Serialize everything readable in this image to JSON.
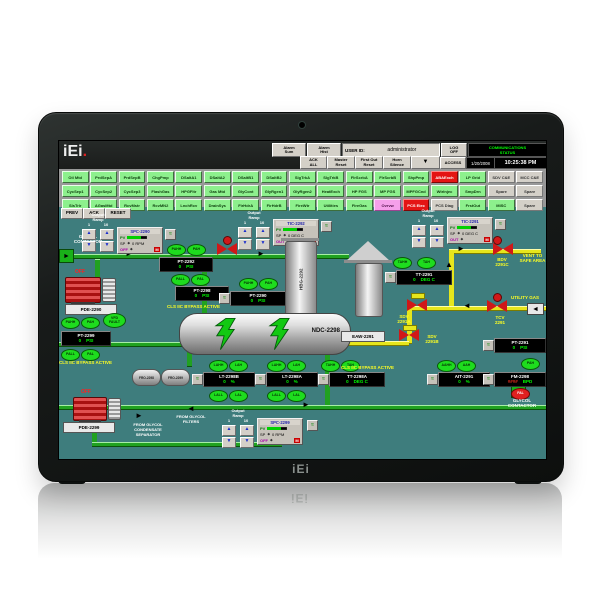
{
  "device": {
    "front_logo": "iEi",
    "reflection_logo": "iEi",
    "screen_logo_text": "iEi",
    "screen_logo_dot": "."
  },
  "icons": {
    "up": "▲",
    "down": "▼",
    "left": "◄",
    "right": "►",
    "trend": "≈",
    "diamond": "◆"
  },
  "header": {
    "alarm_sum": "Alarm\nSum",
    "alarm_hist": "Alarm\nHist",
    "user_id_label": "USER ID:",
    "user_id_value": "administrator",
    "log_off": "LOG\nOFF",
    "comm_status": "COMMUNICATIONS\nSTATUS",
    "ack_all": "ACK\nALL",
    "master_reset": "Master\nReset",
    "first_out_reset": "First Out\nReset",
    "horn_silence": "Horn\nSilence",
    "access": "ACCESS",
    "date": "1/20/2008",
    "time": "10:25:38 PM"
  },
  "nav_grid": {
    "rows": [
      [
        {
          "label": "Oil Mtd",
          "color": "green"
        },
        {
          "label": "PrdSepA",
          "color": "green"
        },
        {
          "label": "PrdSepB",
          "color": "green"
        },
        {
          "label": "ChgPmp",
          "color": "green"
        },
        {
          "label": "DSaltA1",
          "color": "green"
        },
        {
          "label": "DSaltA2",
          "color": "green"
        },
        {
          "label": "DSaltB1",
          "color": "green"
        },
        {
          "label": "DSaltB2",
          "color": "green"
        },
        {
          "label": "SlgTrkA",
          "color": "green"
        },
        {
          "label": "SlgTrkB",
          "color": "green"
        },
        {
          "label": "FlrScrbA",
          "color": "green"
        },
        {
          "label": "FlrScrbB",
          "color": "green"
        },
        {
          "label": "ShpPmp",
          "color": "green"
        },
        {
          "label": "ABAExch",
          "color": "red"
        },
        {
          "label": "LP Grid",
          "color": "green"
        },
        {
          "label": "SDV C&E",
          "color": "gray"
        },
        {
          "label": "MCC C&E",
          "color": "gray"
        }
      ],
      [
        {
          "label": "CycSep1",
          "color": "green"
        },
        {
          "label": "CycSep2",
          "color": "green"
        },
        {
          "label": "CycSep3",
          "color": "green"
        },
        {
          "label": "FlashGas",
          "color": "green"
        },
        {
          "label": "HPGFltr",
          "color": "green"
        },
        {
          "label": "Gas Mtd",
          "color": "green"
        },
        {
          "label": "GlyCont",
          "color": "green"
        },
        {
          "label": "GlyRgen1",
          "color": "green"
        },
        {
          "label": "GlyRgen2",
          "color": "green"
        },
        {
          "label": "HeatExch",
          "color": "green"
        },
        {
          "label": "HP FGS",
          "color": "green"
        },
        {
          "label": "MP FGS",
          "color": "green"
        },
        {
          "label": "MPFGCnd",
          "color": "green"
        },
        {
          "label": "WtrInjec",
          "color": "green"
        },
        {
          "label": "SmpDrn",
          "color": "green"
        },
        {
          "label": "Spare",
          "color": "gray"
        },
        {
          "label": "Spare",
          "color": "gray"
        }
      ],
      [
        {
          "label": "SlsTrlr",
          "color": "green"
        },
        {
          "label": "AGasMtd",
          "color": "green"
        },
        {
          "label": "RcvMstr",
          "color": "green"
        },
        {
          "label": "RcvMN2",
          "color": "green"
        },
        {
          "label": "LnchRcv",
          "color": "green"
        },
        {
          "label": "DrainSys",
          "color": "green"
        },
        {
          "label": "FirHdrA",
          "color": "green"
        },
        {
          "label": "FirHdrB",
          "color": "green"
        },
        {
          "label": "FireWtr",
          "color": "green"
        },
        {
          "label": "Utilities",
          "color": "green"
        },
        {
          "label": "FireGas",
          "color": "green"
        },
        {
          "label": "Ovrvw",
          "color": "pink"
        },
        {
          "label": "PCS Elec",
          "color": "red"
        },
        {
          "label": "PCS Diag",
          "color": "gray"
        },
        {
          "label": "FrstOut",
          "color": "green"
        },
        {
          "label": "MISC",
          "color": "green"
        },
        {
          "label": "Spare",
          "color": "gray"
        }
      ]
    ]
  },
  "alarm_bar": {
    "prev": "PREV",
    "ack": "ACK",
    "reset": "RESET"
  },
  "hmi": {
    "texts": {
      "glycol_contactor_left": "GLYCOL\nCONTACTOR",
      "glycol_contactor_right": "GLYCOL\nCONTACTOR",
      "bypass_active": "CLS IIC BYPASS ACTIVE",
      "vent_safe_area": "VENT TO\nSAFE AREA",
      "utility_gas": "UTILITY GAS",
      "bdv_2291c": "BDV\n2291C",
      "tcv_2291": "TCV\n2291",
      "sdv_2291a": "SDV\n2291A",
      "sdv_2291b": "SDV\n2291B",
      "from_condensate": "FROM GLYCOL\nCONDENSATE\nSEPARATOR",
      "from_filters": "FROM GLYCOL\nFILTERS",
      "pump1_status": "OFF",
      "pump2_status": "OFF"
    },
    "equipment": {
      "vessel": "NDC-2298",
      "exchanger_tag": "EAW-2291",
      "column": "HBG-2292",
      "pump1": "PDE-2290",
      "pump2": "PDE-2299",
      "drum1": "FRO-2298",
      "drum2": "FRO-2299"
    },
    "output_ramp": {
      "label": "Output\nRamp",
      "range_low": "1",
      "range_high": "10"
    },
    "faceplates": [
      {
        "title": "SPC-2290",
        "pv": "PV",
        "sp_label": "SP",
        "sp_value": "0 RPM",
        "out_label": "OFF",
        "mode": "M"
      },
      {
        "title": "TIC-2292",
        "pv": "PV",
        "sp_label": "SP",
        "sp_value": "0 DEG C",
        "out_label": "OUT",
        "mode": "M"
      },
      {
        "title": "TIC-2291",
        "pv": "PV",
        "sp_label": "SP",
        "sp_value": "0 DEG C",
        "out_label": "OUT",
        "mode": "M"
      },
      {
        "title": "SPC-2299",
        "pv": "PV",
        "sp_label": "SP",
        "sp_value": "0 RPM",
        "out_label": "OFF",
        "mode": "M"
      }
    ],
    "readouts": [
      {
        "title": "PT-2292",
        "value": "0",
        "unit": "PSI"
      },
      {
        "title": "PT-2298",
        "value": "0",
        "unit": "PSI"
      },
      {
        "title": "PT-2299",
        "value": "0",
        "unit": "PSI"
      },
      {
        "title": "PT-2290",
        "value": "0",
        "unit": "PSI"
      },
      {
        "title": "TT-2291",
        "value": "0",
        "unit": "DEG C"
      },
      {
        "title": "LT-2298B",
        "value": "0",
        "unit": "%"
      },
      {
        "title": "LT-2298A",
        "value": "0",
        "unit": "%"
      },
      {
        "title": "TT-2298A",
        "value": "0",
        "unit": "DEG C"
      },
      {
        "title": "AIT-2291",
        "value": "0",
        "unit": "%"
      },
      {
        "title": "PT-2291",
        "value": "0",
        "unit": "PSI"
      },
      {
        "title": "FM-2298",
        "value": "####",
        "unit": "BPD"
      }
    ],
    "alarm_tags": [
      "PAHH",
      "PAH",
      "PALL",
      "PAL",
      "PAHH",
      "PAH",
      "VFD\nFAULT",
      "PALL",
      "PAL",
      "PAHH",
      "PAH",
      "TAHH",
      "TAH",
      "LAHH",
      "LAH",
      "LALL",
      "LAL",
      "LAHH",
      "LAH",
      "LALL",
      "LAL",
      "TAHH",
      "TAH",
      "AAHH",
      "AAH",
      "PAH",
      "FAL"
    ]
  }
}
